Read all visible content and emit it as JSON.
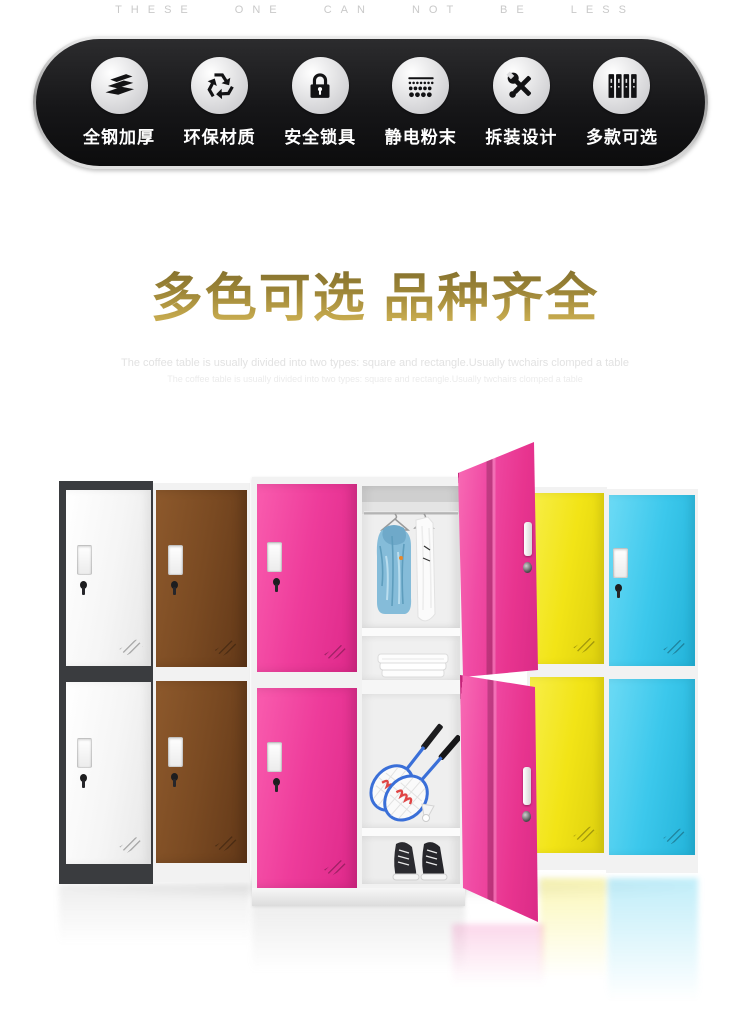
{
  "tagline": "THESE ONE CAN NOT BE LESS",
  "features": {
    "items": [
      {
        "label": "全钢加厚",
        "icon": "layers-icon"
      },
      {
        "label": "环保材质",
        "icon": "recycle-icon"
      },
      {
        "label": "安全锁具",
        "icon": "lock-icon"
      },
      {
        "label": "静电粉末",
        "icon": "powder-icon"
      },
      {
        "label": "拆装设计",
        "icon": "tools-icon"
      },
      {
        "label": "多款可选",
        "icon": "lockers-icon"
      }
    ]
  },
  "headline": "多色可选 品种齐全",
  "subtitle_en_1": "The coffee table is usually divided into two types: square and rectangle.Usually twchairs clomped a table",
  "subtitle_en_2": "The coffee table is usually divided into two types: square and rectangle.Usually twchairs clomped a table",
  "colors": {
    "banner_bg": "#161618",
    "gold_dark": "#796729",
    "gold_light": "#d8ba58",
    "locker_white": "#f6f6f6",
    "locker_white_frame": "#3a3c3f",
    "locker_brown": "#7a4a22",
    "locker_pink": "#ee3c9b",
    "locker_yellow": "#f2e416",
    "locker_cyan": "#3cc8ec",
    "frame_light": "#f2f2f2"
  }
}
